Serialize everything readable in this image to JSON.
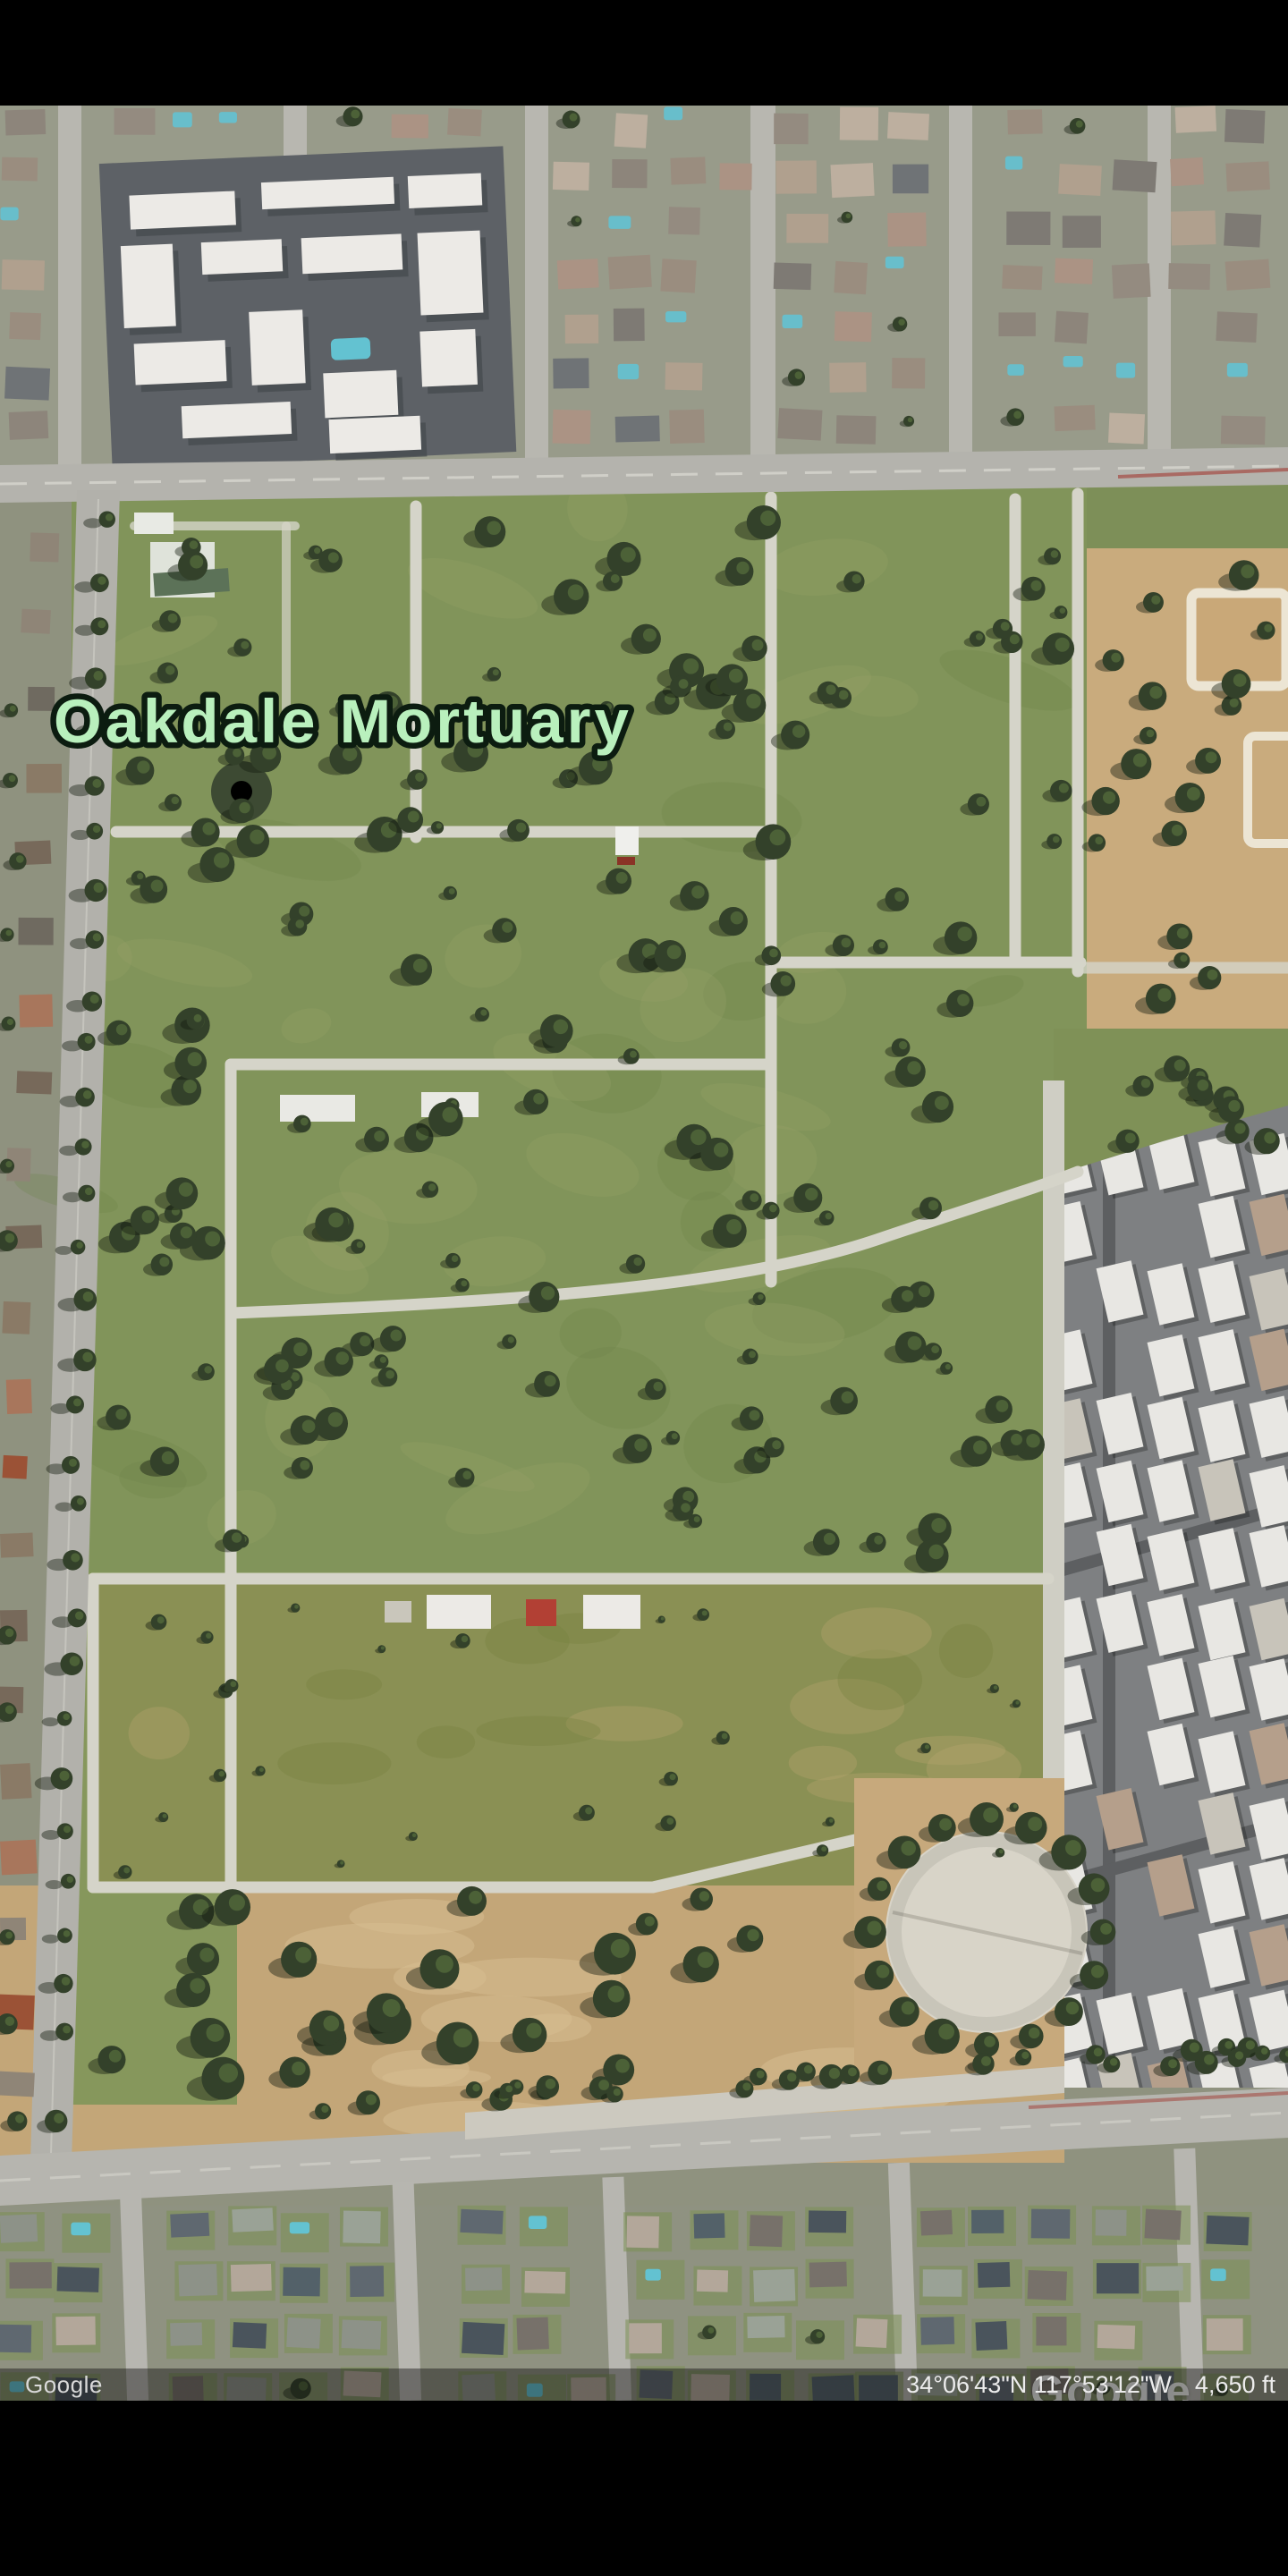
{
  "map": {
    "place_label": "Oakdale Mortuary",
    "watermark": "Google"
  },
  "status_bar": {
    "attribution": "Google",
    "coordinates": "34°06'43\"N 117°53'12\"W",
    "altitude": "4,650 ft"
  },
  "colors": {
    "label_green": "#b9f0bd",
    "label_outline": "#0c1c10",
    "grass": "#81945a",
    "grass_olive": "#8a9054",
    "path": "#d5d4c9",
    "road": "#b4b3ad",
    "dirt": "#c9ab7d",
    "asphalt": "#5d6166",
    "roof_white": "#eceae6",
    "tree": "#33412a",
    "pool_teal": "#63c2d1",
    "status_text": "#d9d9d9",
    "watermark_white": "#ffffff"
  }
}
